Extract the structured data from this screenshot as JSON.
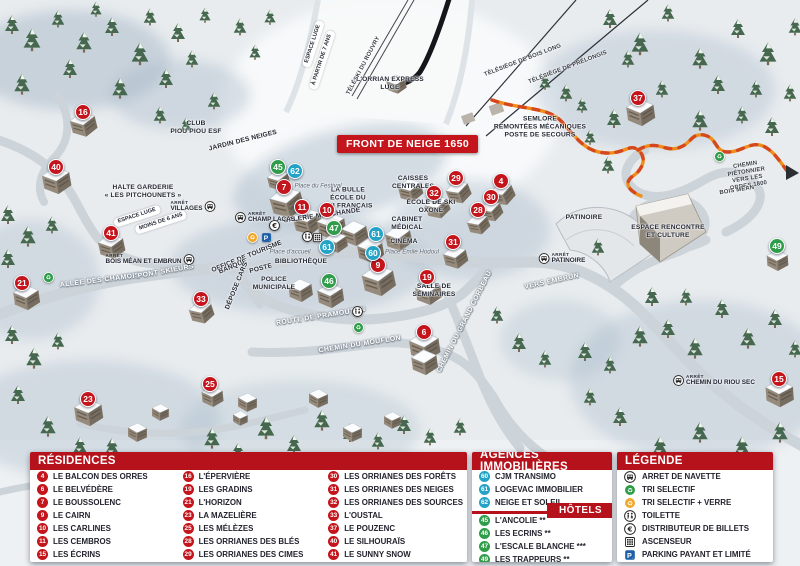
{
  "colors": {
    "header_red": "#b5121b",
    "badge_red": "#c4151c",
    "badge_blue": "#24a3c6",
    "badge_green": "#2f9c49",
    "path_orange": "#ef8f1a",
    "path_dash": "#d5481f",
    "text_dark": "#23232e"
  },
  "map": {
    "banner": "FRONT DE NEIGE 1650",
    "arret_label": "ARRÊT",
    "markers": [
      {
        "n": 16,
        "c": "r",
        "x": 83,
        "y": 112
      },
      {
        "n": 40,
        "c": "r",
        "x": 56,
        "y": 167
      },
      {
        "n": 41,
        "c": "r",
        "x": 111,
        "y": 233
      },
      {
        "n": 21,
        "c": "r",
        "x": 22,
        "y": 283
      },
      {
        "n": 33,
        "c": "r",
        "x": 201,
        "y": 299
      },
      {
        "n": 23,
        "c": "r",
        "x": 88,
        "y": 399
      },
      {
        "n": 25,
        "c": "r",
        "x": 210,
        "y": 384
      },
      {
        "n": 7,
        "c": "r",
        "x": 284,
        "y": 187
      },
      {
        "n": 11,
        "c": "r",
        "x": 302,
        "y": 207
      },
      {
        "n": 10,
        "c": "r",
        "x": 327,
        "y": 210
      },
      {
        "n": 9,
        "c": "r",
        "x": 378,
        "y": 265
      },
      {
        "n": 19,
        "c": "r",
        "x": 427,
        "y": 277
      },
      {
        "n": 6,
        "c": "r",
        "x": 424,
        "y": 332
      },
      {
        "n": 29,
        "c": "r",
        "x": 456,
        "y": 178
      },
      {
        "n": 32,
        "c": "r",
        "x": 434,
        "y": 193
      },
      {
        "n": 4,
        "c": "r",
        "x": 501,
        "y": 181
      },
      {
        "n": 30,
        "c": "r",
        "x": 491,
        "y": 197
      },
      {
        "n": 28,
        "c": "r",
        "x": 478,
        "y": 210
      },
      {
        "n": 31,
        "c": "r",
        "x": 453,
        "y": 242
      },
      {
        "n": 37,
        "c": "r",
        "x": 638,
        "y": 98
      },
      {
        "n": 15,
        "c": "r",
        "x": 779,
        "y": 379
      },
      {
        "n": 62,
        "c": "b",
        "x": 295,
        "y": 171
      },
      {
        "n": 61,
        "c": "b",
        "x": 327,
        "y": 247
      },
      {
        "n": 61,
        "c": "b",
        "x": 376,
        "y": 234
      },
      {
        "n": 60,
        "c": "b",
        "x": 373,
        "y": 253
      },
      {
        "n": 45,
        "c": "g",
        "x": 278,
        "y": 167
      },
      {
        "n": 47,
        "c": "g",
        "x": 334,
        "y": 228
      },
      {
        "n": 46,
        "c": "g",
        "x": 329,
        "y": 281
      },
      {
        "n": 49,
        "c": "g",
        "x": 777,
        "y": 246
      }
    ],
    "labels": [
      {
        "t": "CLUB\nPIOU PIOU ESF",
        "x": 196,
        "y": 128,
        "c": "fac"
      },
      {
        "t": "JARDIN DES NEIGES",
        "x": 243,
        "y": 141,
        "r": -14,
        "c": "fac"
      },
      {
        "t": "HALTE GARDERIE\n« LES PITCHOUNETS »",
        "x": 143,
        "y": 192,
        "c": "fac"
      },
      {
        "t": "L'ORRIAN EXPRESS\nLUGE",
        "x": 390,
        "y": 84,
        "c": "fac"
      },
      {
        "t": "SEMLORE\nREMONTÉES MÉCANIQUES\nPOSTE DE SECOURS",
        "x": 540,
        "y": 127,
        "c": "fac"
      },
      {
        "t": "LA BULLE\nÉCOLE DU\nSKI FRANÇAIS",
        "x": 348,
        "y": 198,
        "c": "fac"
      },
      {
        "t": "CAISSES\nCENTRALES",
        "x": 413,
        "y": 183,
        "c": "fac"
      },
      {
        "t": "CABINET\nMÉDICAL",
        "x": 407,
        "y": 224,
        "c": "fac"
      },
      {
        "t": "CINÉMA",
        "x": 404,
        "y": 242,
        "c": "fac"
      },
      {
        "t": "GALERIE MARCHANDE",
        "x": 322,
        "y": 216,
        "r": -8,
        "c": "fac"
      },
      {
        "t": "LAVERIE",
        "x": 452,
        "y": 152,
        "c": "fac"
      },
      {
        "t": "ÉCOLE DE SKI\nOXONE",
        "x": 431,
        "y": 207,
        "c": "fac"
      },
      {
        "t": "OFFICE DE TOURISME",
        "x": 247,
        "y": 257,
        "r": -22,
        "c": "fac"
      },
      {
        "t": "BANQUE",
        "x": 233,
        "y": 267,
        "r": -22,
        "c": "fac"
      },
      {
        "t": "POSTE",
        "x": 261,
        "y": 269,
        "r": -15,
        "c": "fac"
      },
      {
        "t": "BIBLIOTHÈQUE",
        "x": 301,
        "y": 262,
        "c": "fac"
      },
      {
        "t": "POLICE\nMUNICIPALE",
        "x": 274,
        "y": 284,
        "c": "fac"
      },
      {
        "t": "DÉPOSE CARS",
        "x": 237,
        "y": 286,
        "r": -68,
        "c": "fac"
      },
      {
        "t": "SALLE DE\nSÉMINAIRES",
        "x": 434,
        "y": 291,
        "c": "fac"
      },
      {
        "t": "PATINOIRE",
        "x": 584,
        "y": 218,
        "c": "fac"
      },
      {
        "t": "ESPACE RENCONTRE\nET CULTURE",
        "x": 668,
        "y": 232,
        "c": "fac"
      },
      {
        "t": "ALLÉE DES CHAMOIS",
        "x": 100,
        "y": 281,
        "r": -7,
        "c": "road"
      },
      {
        "t": "PONT SKIEURS",
        "x": 166,
        "y": 272,
        "r": -10,
        "c": "road"
      },
      {
        "t": "ROUTE DE PRAMOUTON",
        "x": 321,
        "y": 317,
        "r": -9,
        "c": "road"
      },
      {
        "t": "CHEMIN DU MOUFLON",
        "x": 360,
        "y": 345,
        "r": -9,
        "c": "road"
      },
      {
        "t": "CHEMIN DU GRAND CORBEAU",
        "x": 465,
        "y": 322,
        "r": -63,
        "c": "road"
      },
      {
        "t": "VERS EMBRUN",
        "x": 552,
        "y": 282,
        "r": -12,
        "c": "road"
      },
      {
        "t": "CHEMIN PIÉTONNIER\nVERS LES ORRES 1800",
        "x": 747,
        "y": 176,
        "r": -9,
        "c": "lift"
      },
      {
        "t": "BOIS MÉAN",
        "x": 737,
        "y": 191,
        "r": -9,
        "c": "lift"
      },
      {
        "t": "TÉLÉSKI DU ROUVRY",
        "x": 364,
        "y": 66,
        "r": -62,
        "c": "lift"
      },
      {
        "t": "TÉLÉSIÈGE DE BOIS LONG",
        "x": 523,
        "y": 61,
        "r": -21,
        "c": "lift"
      },
      {
        "t": "TÉLÉSIÈGE DE PRÉLONGIS",
        "x": 568,
        "y": 68,
        "r": -21,
        "c": "lift"
      },
      {
        "t": "Place du Festival",
        "x": 318,
        "y": 186,
        "c": "place"
      },
      {
        "t": "Place d'accueil",
        "x": 290,
        "y": 252,
        "c": "place"
      },
      {
        "t": "Place Émile Hodoul",
        "x": 412,
        "y": 252,
        "c": "place"
      },
      {
        "t": "ESPACE LUGE",
        "x": 313,
        "y": 44,
        "r": -72,
        "c": "pill"
      },
      {
        "t": "À PARTIR DE 7 ANS",
        "x": 322,
        "y": 60,
        "r": -72,
        "c": "pill"
      },
      {
        "t": "ESPACE LUGE",
        "x": 137,
        "y": 216,
        "r": -18,
        "c": "pill"
      },
      {
        "t": "MOINS DE 6 ANS",
        "x": 161,
        "y": 222,
        "r": -18,
        "c": "pill"
      }
    ],
    "stops": [
      {
        "t": "VILLAGES",
        "x": 193,
        "y": 206,
        "iconAfter": true
      },
      {
        "t": "CHAMP LACAS",
        "x": 265,
        "y": 217
      },
      {
        "t": "BOIS MÉAN ET EMBRUN",
        "x": 150,
        "y": 259,
        "iconAfter": true
      },
      {
        "t": "PATINOIRE",
        "x": 562,
        "y": 258
      },
      {
        "t": "CHEMIN DU RIOU SEC",
        "x": 714,
        "y": 380
      }
    ],
    "icons": [
      {
        "type": "recycle",
        "x": 48,
        "y": 277
      },
      {
        "type": "recycle",
        "x": 358,
        "y": 327
      },
      {
        "type": "recycle",
        "x": 719,
        "y": 156
      },
      {
        "type": "recycle2",
        "x": 252,
        "y": 237
      },
      {
        "type": "parking",
        "x": 266,
        "y": 237
      },
      {
        "type": "euro",
        "x": 274,
        "y": 225
      },
      {
        "type": "toilet",
        "x": 307,
        "y": 236
      },
      {
        "type": "elevator",
        "x": 317,
        "y": 237
      },
      {
        "type": "toilet",
        "x": 357,
        "y": 311
      }
    ]
  },
  "legend": {
    "residences": {
      "title": "RÉSIDENCES",
      "items": [
        {
          "n": 4,
          "t": "LE BALCON DES ORRES"
        },
        {
          "n": 6,
          "t": "LE BELVÉDÈRE"
        },
        {
          "n": 7,
          "t": "LE BOUSSOLENC"
        },
        {
          "n": 9,
          "t": "LE CAIRN"
        },
        {
          "n": 10,
          "t": "LES CARLINES"
        },
        {
          "n": 11,
          "t": "LES CEMBROS"
        },
        {
          "n": 15,
          "t": "LES ÉCRINS"
        },
        {
          "n": 16,
          "t": "L'ÉPERVIÈRE"
        },
        {
          "n": 19,
          "t": "LES GRADINS"
        },
        {
          "n": 21,
          "t": "L'HORIZON"
        },
        {
          "n": 23,
          "t": "LA MAZELIÈRE"
        },
        {
          "n": 25,
          "t": "LES MÉLÈZES"
        },
        {
          "n": 28,
          "t": "LES ORRIANES DES BLÉS"
        },
        {
          "n": 29,
          "t": "LES ORRIANES DES CIMES"
        },
        {
          "n": 30,
          "t": "LES ORRIANES DES FORÊTS"
        },
        {
          "n": 31,
          "t": "LES ORRIANES DES NEIGES"
        },
        {
          "n": 32,
          "t": "LES ORRIANES DES SOURCES"
        },
        {
          "n": 33,
          "t": "L'OUSTAL"
        },
        {
          "n": 37,
          "t": "LE POUZENC"
        },
        {
          "n": 40,
          "t": "LE SILHOURAÏS"
        },
        {
          "n": 41,
          "t": "LE SUNNY SNOW"
        }
      ]
    },
    "agences": {
      "title": "AGENCES IMMOBILIÈRES",
      "items": [
        {
          "n": 60,
          "t": "CJM TRANSIMO"
        },
        {
          "n": 61,
          "t": "LOGEVAC IMMOBILIER"
        },
        {
          "n": 62,
          "t": "NEIGE ET SOLEIL"
        }
      ]
    },
    "hotels": {
      "title": "HÔTELS",
      "items": [
        {
          "n": 45,
          "t": "L'ANCOLIE **"
        },
        {
          "n": 46,
          "t": "LES ECRINS **"
        },
        {
          "n": 47,
          "t": "L'ESCALE BLANCHE ***"
        },
        {
          "n": 49,
          "t": "LES TRAPPEURS **"
        }
      ]
    },
    "legende": {
      "title": "LÉGENDE",
      "items": [
        {
          "icon": "bus-icon",
          "t": "ARRET DE NAVETTE"
        },
        {
          "icon": "recycle-green-icon",
          "t": "TRI SELECTIF"
        },
        {
          "icon": "recycle-yellow-icon",
          "t": "TRI SELECTIF + VERRE"
        },
        {
          "icon": "toilet-icon",
          "t": "TOILETTE"
        },
        {
          "icon": "euro-icon",
          "t": "DISTRIBUTEUR DE BILLETS"
        },
        {
          "icon": "elevator-icon",
          "t": "ASCENSEUR"
        },
        {
          "icon": "parking-icon",
          "t": "PARKING PAYANT ET LIMITÉ"
        }
      ]
    }
  }
}
